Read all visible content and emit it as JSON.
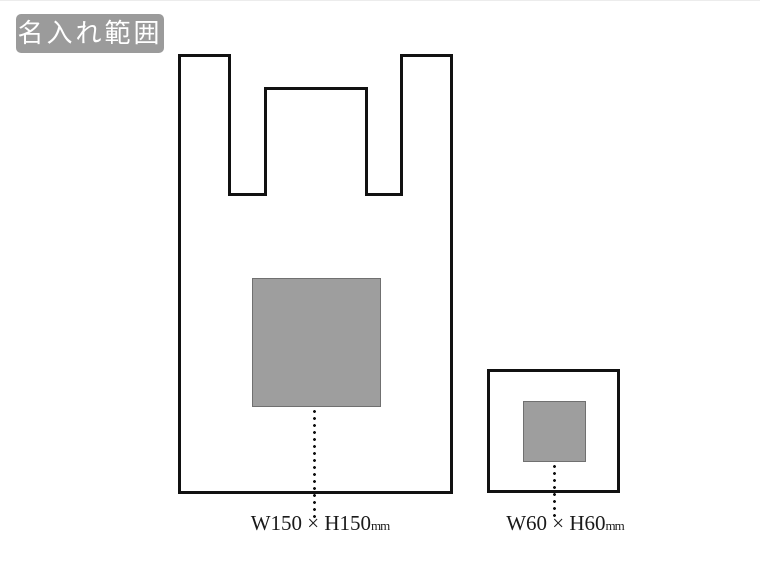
{
  "badge": {
    "label": "名入れ範囲"
  },
  "colors": {
    "badge_bg": "#9b9b9b",
    "badge_text": "#ffffff",
    "outline": "#111111",
    "print_area_fill": "#9e9e9e",
    "label_text": "#1a1a1a"
  },
  "large_bag": {
    "dimension": "W150 × H150",
    "unit": "mm"
  },
  "small_bag": {
    "dimension": "W60 × H60",
    "unit": "mm"
  }
}
